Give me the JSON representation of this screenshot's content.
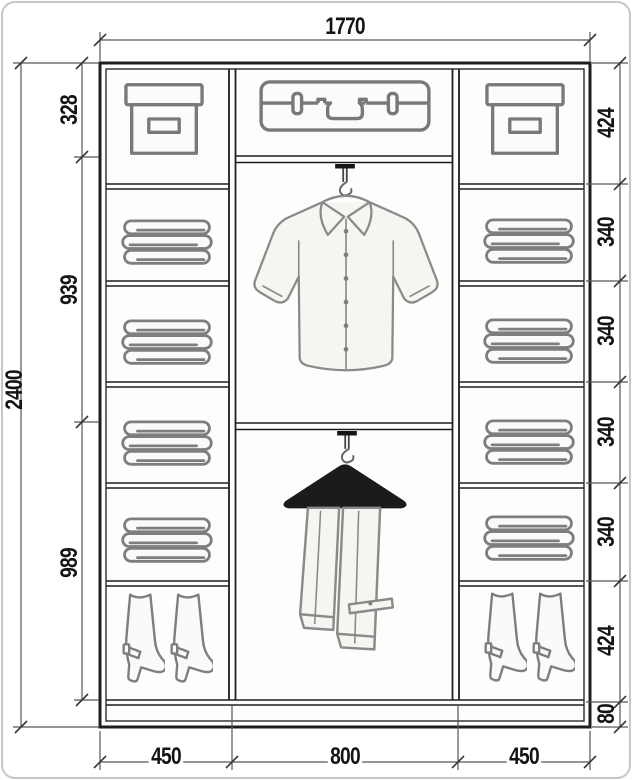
{
  "drawing": {
    "type": "wardrobe-interior-dimension-drawing",
    "units": "mm",
    "overall": {
      "width": "1770",
      "height": "2400"
    },
    "left_sections": [
      "328",
      "939",
      "989"
    ],
    "right_sections": [
      "424",
      "340",
      "340",
      "340",
      "340",
      "424",
      "80"
    ],
    "bottom_sections": [
      "450",
      "800",
      "450"
    ],
    "items": {
      "left_column": [
        "storage-box",
        "folded-clothes",
        "folded-clothes",
        "folded-clothes",
        "folded-clothes",
        "boots"
      ],
      "middle_column": [
        "suitcase",
        "shirt-on-hook",
        "trousers-on-hanger"
      ],
      "right_column": [
        "storage-box",
        "folded-clothes",
        "folded-clothes",
        "folded-clothes",
        "folded-clothes",
        "boots"
      ]
    },
    "colors": {
      "structure_line": "#1e1e1e",
      "sketch_line": "#7e7e7e",
      "dimension_line": "#565656",
      "label_text": "#141414",
      "background": "#ffffff"
    }
  }
}
